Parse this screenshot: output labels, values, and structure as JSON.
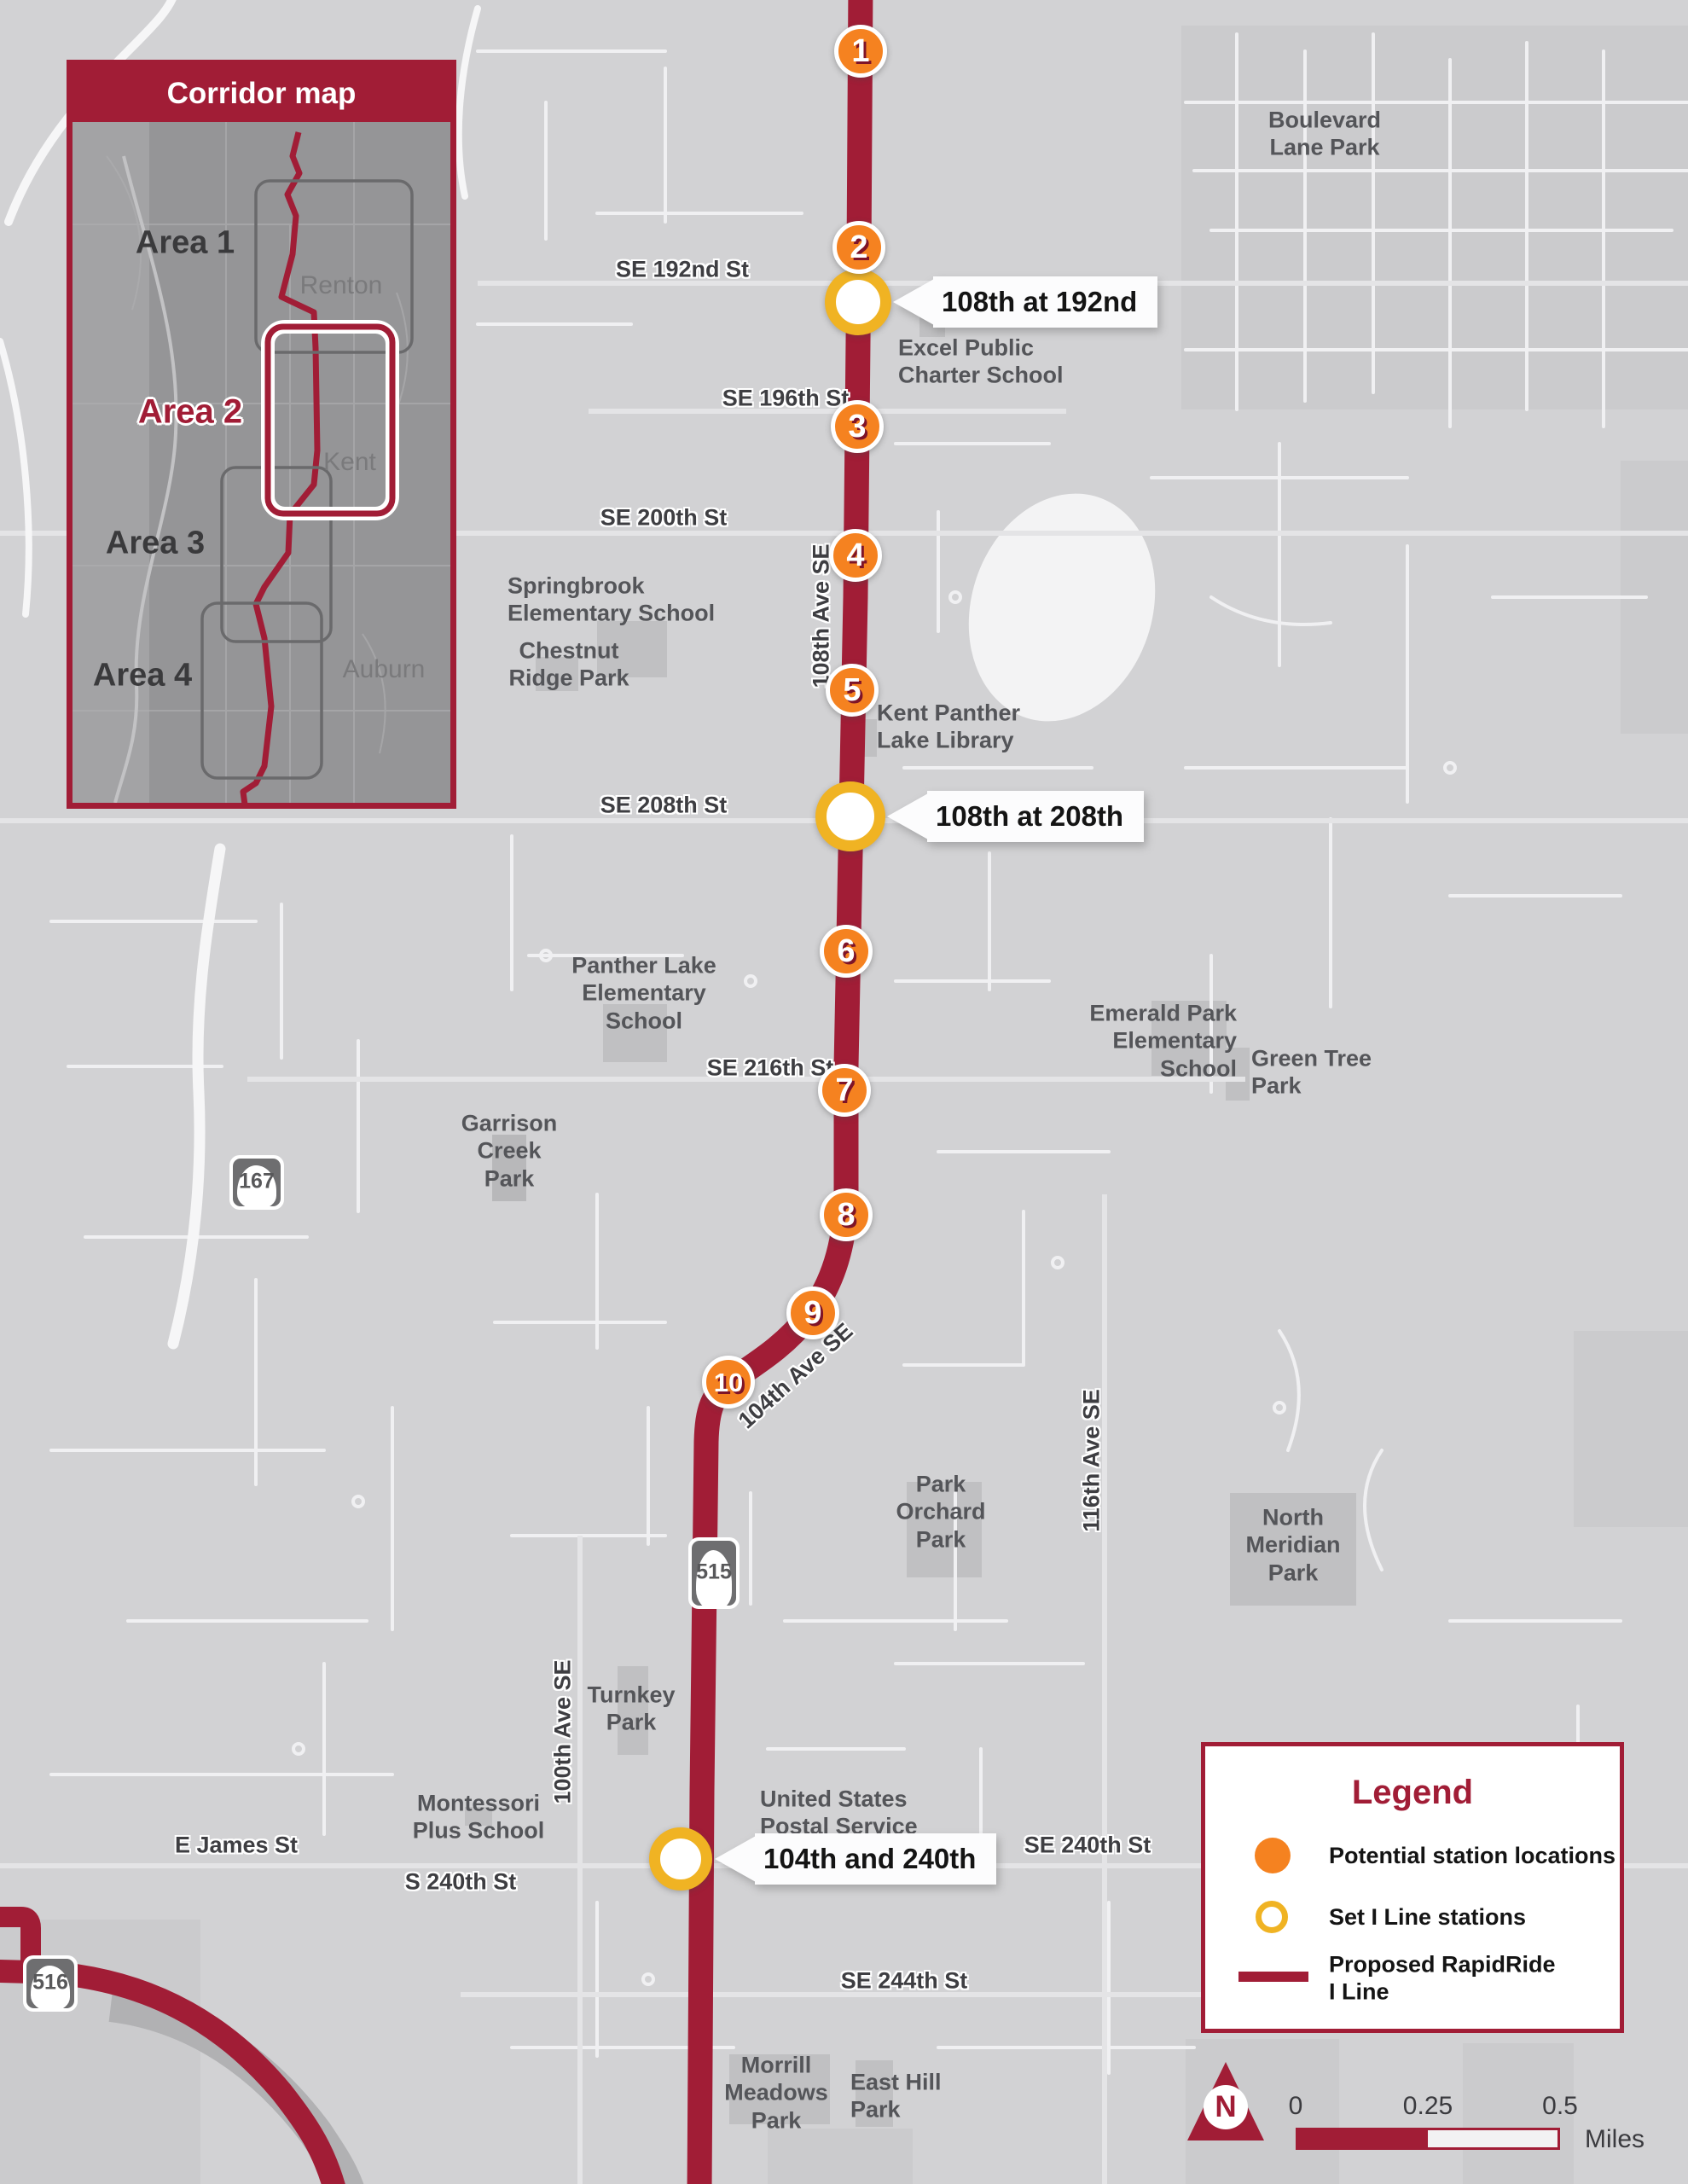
{
  "inset": {
    "title": "Corridor map",
    "areas": [
      {
        "label": "Area 1"
      },
      {
        "label": "Area 2"
      },
      {
        "label": "Area 3"
      },
      {
        "label": "Area 4"
      }
    ],
    "cities": [
      {
        "name": "Renton"
      },
      {
        "name": "Kent"
      },
      {
        "name": "Auburn"
      }
    ]
  },
  "stations": {
    "numbered": [
      {
        "number": "1"
      },
      {
        "number": "2"
      },
      {
        "number": "3"
      },
      {
        "number": "4"
      },
      {
        "number": "5"
      },
      {
        "number": "6"
      },
      {
        "number": "7"
      },
      {
        "number": "8"
      },
      {
        "number": "9"
      },
      {
        "number": "10"
      }
    ],
    "set": [
      {
        "label": "108th at 192nd"
      },
      {
        "label": "108th at 208th"
      },
      {
        "label": "104th and 240th"
      }
    ]
  },
  "streets": {
    "se192nd": "SE 192nd St",
    "se196th": "SE 196th St",
    "se200th": "SE 200th St",
    "se208th": "SE 208th St",
    "se216th": "SE 216th St",
    "se240th": "SE 240th St",
    "s240th": "S 240th St",
    "se244th": "SE 244th St",
    "ejames": "E James St",
    "ave108": "108th Ave SE",
    "ave104": "104th Ave SE",
    "ave116": "116th Ave SE",
    "ave100": "100th Ave SE"
  },
  "places": {
    "boulevard": "Boulevard\nLane Park",
    "excel": "Excel Public\nCharter School",
    "springbrook": "Springbrook\nElementary School",
    "chestnut": "Chestnut\nRidge Park",
    "library": "Kent Panther\nLake Library",
    "pantherlake": "Panther Lake\nElementary\nSchool",
    "emerald": "Emerald Park\nElementary\nSchool",
    "greentree": "Green Tree\nPark",
    "garrison": "Garrison\nCreek\nPark",
    "parkorchard": "Park\nOrchard\nPark",
    "northmeridian": "North\nMeridian\nPark",
    "turnkey": "Turnkey\nPark",
    "montessori": "Montessori\nPlus School",
    "usps": "United States\nPostal Service",
    "morrill": "Morrill\nMeadows\nPark",
    "easthill": "East Hill\nPark"
  },
  "shields": {
    "sr167": "167",
    "sr515": "515",
    "sr516": "516"
  },
  "legend": {
    "title": "Legend",
    "items": [
      {
        "label": "Potential station locations"
      },
      {
        "label": "Set I Line stations"
      },
      {
        "label": "Proposed RapidRide\nI Line"
      }
    ]
  },
  "scalebar": {
    "zero": "0",
    "quarter": "0.25",
    "half": "0.5",
    "unit": "Miles"
  },
  "north_label": "N",
  "colors": {
    "route_line": "#A11D36",
    "potential_station": "#F58220",
    "set_station_ring": "#F0B323"
  }
}
